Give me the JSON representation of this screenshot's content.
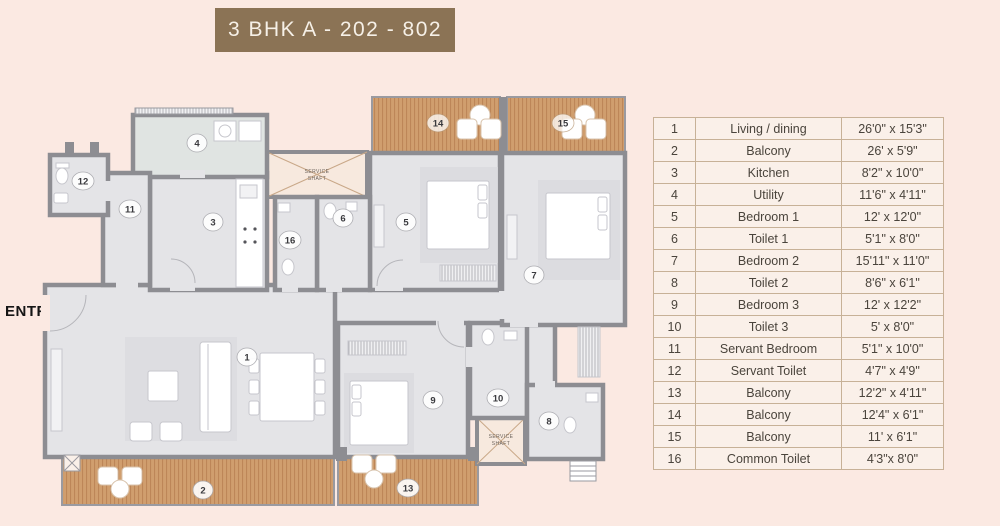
{
  "title": "3 BHK A - 202 - 802",
  "entry": {
    "label": "ENTRY"
  },
  "colors": {
    "background": "#fbe9e2",
    "banner": "#8b7355",
    "wall_gray": "#8d8d92",
    "room_fill": "#e4e4e7",
    "balcony_wood": "#d09e6e",
    "table_border": "#c7b197",
    "entry_arrow_red": "#c23b42"
  },
  "plan": {
    "service_shaft": {
      "line1": "SERVICE",
      "line2": "SHAFT"
    },
    "labels": [
      {
        "n": "1"
      },
      {
        "n": "2"
      },
      {
        "n": "3"
      },
      {
        "n": "4"
      },
      {
        "n": "5"
      },
      {
        "n": "6"
      },
      {
        "n": "7"
      },
      {
        "n": "8"
      },
      {
        "n": "9"
      },
      {
        "n": "10"
      },
      {
        "n": "11"
      },
      {
        "n": "12"
      },
      {
        "n": "13"
      },
      {
        "n": "14"
      },
      {
        "n": "15"
      },
      {
        "n": "16"
      }
    ]
  },
  "table": {
    "rows": [
      {
        "no": "1",
        "name": "Living / dining",
        "size": "26'0\" x 15'3\""
      },
      {
        "no": "2",
        "name": "Balcony",
        "size": "26' x 5'9\""
      },
      {
        "no": "3",
        "name": "Kitchen",
        "size": "8'2\" x 10'0\""
      },
      {
        "no": "4",
        "name": "Utility",
        "size": "11'6\" x 4'11\""
      },
      {
        "no": "5",
        "name": "Bedroom 1",
        "size": "12' x 12'0\""
      },
      {
        "no": "6",
        "name": "Toilet 1",
        "size": "5'1\" x 8'0\""
      },
      {
        "no": "7",
        "name": "Bedroom 2",
        "size": "15'11\" x 11'0\""
      },
      {
        "no": "8",
        "name": "Toilet 2",
        "size": "8'6\" x 6'1\""
      },
      {
        "no": "9",
        "name": "Bedroom 3",
        "size": "12' x 12'2\""
      },
      {
        "no": "10",
        "name": "Toilet 3",
        "size": "5' x 8'0\""
      },
      {
        "no": "11",
        "name": "Servant Bedroom",
        "size": "5'1\" x 10'0\""
      },
      {
        "no": "12",
        "name": "Servant Toilet",
        "size": "4'7\" x 4'9\""
      },
      {
        "no": "13",
        "name": "Balcony",
        "size": "12'2\" x 4'11\""
      },
      {
        "no": "14",
        "name": "Balcony",
        "size": "12'4\" x 6'1\""
      },
      {
        "no": "15",
        "name": "Balcony",
        "size": "11' x 6'1\""
      },
      {
        "no": "16",
        "name": "Common Toilet",
        "size": "4'3\"x 8'0\""
      }
    ]
  }
}
